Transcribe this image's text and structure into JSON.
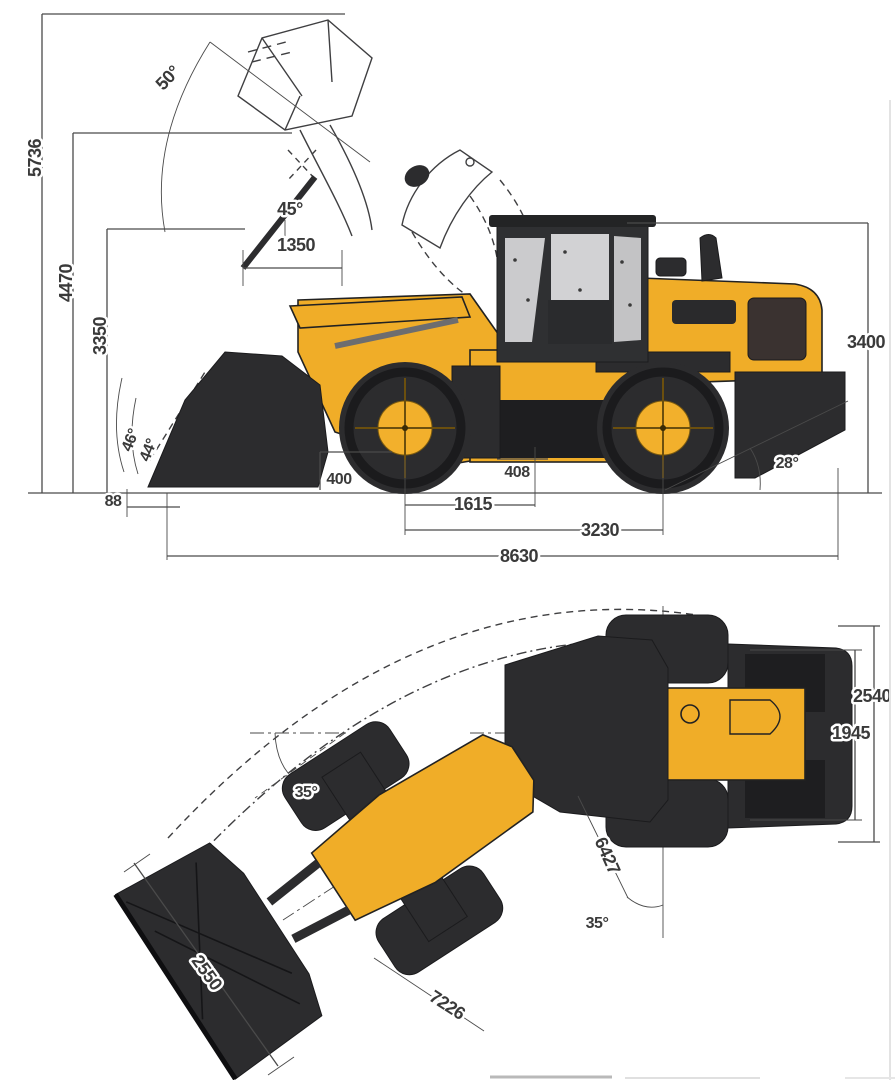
{
  "diagram_title": "wheel-loader-dimensional-drawing",
  "colors": {
    "machine_yellow": "#F0AD28",
    "machine_dark": "#2C2C2E",
    "dimension_line": "#4A4A4A",
    "dimension_text": "#3A3A3A",
    "glass_gray": "#CBCBCD",
    "background": "#FFFFFF"
  },
  "side_view": {
    "dimensions": {
      "overall_height_bucket_raised": "5736",
      "hinge_pin_height": "4470",
      "dump_clearance": "3350",
      "dump_reach": "1350",
      "dump_angle": "45°",
      "rollback_angle_full_height": "50°",
      "rollback_angle_ground_a": "46°",
      "rollback_angle_ground_b": "44°",
      "digging_depth": "88",
      "bucket_carry_clearance": "400",
      "ground_clearance": "408",
      "front_axle_to_hitch": "1615",
      "wheelbase": "3230",
      "overall_length": "8630",
      "overall_height_cab": "3400",
      "departure_angle": "28°"
    }
  },
  "top_view": {
    "dimensions": {
      "overall_width": "2540",
      "width_over_tires": "1945",
      "articulation_angle_upper": "35°",
      "articulation_angle_lower": "35°",
      "turning_radius_over_tires": "6427",
      "turning_radius_over_bucket": "7226",
      "bucket_width": "2550"
    }
  }
}
